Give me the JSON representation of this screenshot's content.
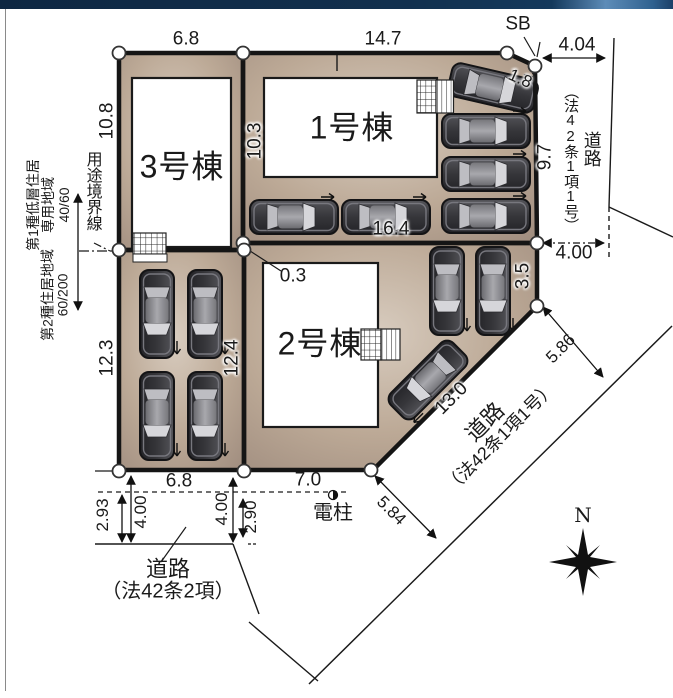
{
  "site_plan": {
    "buildings": [
      {
        "id": "1",
        "label": "1号棟"
      },
      {
        "id": "2",
        "label": "2号棟"
      },
      {
        "id": "3",
        "label": "3号棟"
      }
    ],
    "dimensions": {
      "b3_top_width": "6.8",
      "b1_top_width": "14.7",
      "setback_label": "SB",
      "corner_cut": "1.8",
      "road_right_width_top": "4.04",
      "road_right_width_bottom": "4.00",
      "b3_left_depth": "10.8",
      "b1_left_depth": "10.3",
      "b1_right_depth": "9.7",
      "lot2_top_width": "16.4",
      "lot_gap": "0.3",
      "parking_left_depth": "12.3",
      "lot2_left_depth": "12.4",
      "lot2_right_edge": "3.5",
      "diag_road_width_upper": "5.86",
      "lot2_diag_edge": "13.0",
      "diag_road_width_lower": "5.84",
      "parking_bottom_width": "6.8",
      "lot2_bottom_width": "7.0",
      "bottom_left_offset": "2.93",
      "bottom_left_width": "4.00",
      "bottom_right_width": "4.00",
      "bottom_right_offset": "2.90"
    },
    "roads": {
      "right": {
        "name": "道路",
        "law": "（法42条1項1号）"
      },
      "diagonal": {
        "name": "道路",
        "law": "（法42条1項1号）"
      },
      "bottom": {
        "name": "道路",
        "law": "（法42条2項）"
      }
    },
    "zoning": {
      "boundary_label": "用途境界線",
      "district_upper": {
        "line1": "第1種低層住居",
        "line2": "専用地域",
        "ratio": "40/60"
      },
      "district_lower": {
        "line1": "第2種住居地域",
        "ratio": "60/200"
      }
    },
    "annotations": {
      "utility_pole": "電柱",
      "compass_north": "N"
    }
  },
  "icons": {
    "car": "car-icon",
    "compass": "compass-rose-icon",
    "utility_pole": "utility-pole-icon",
    "stairs": "stairs-icon",
    "corner_marker": "corner-point-icon"
  },
  "colors": {
    "lot_fill": "#b5a294",
    "lot_fill_light": "#d8ccbf",
    "lot_fill_dark": "#a08d7f",
    "boundary": "#151515",
    "building_fill": "#ffffff",
    "header_navy": "#12304e",
    "header_blue": "#5d8cb8",
    "car_body": "#3c3c40"
  }
}
